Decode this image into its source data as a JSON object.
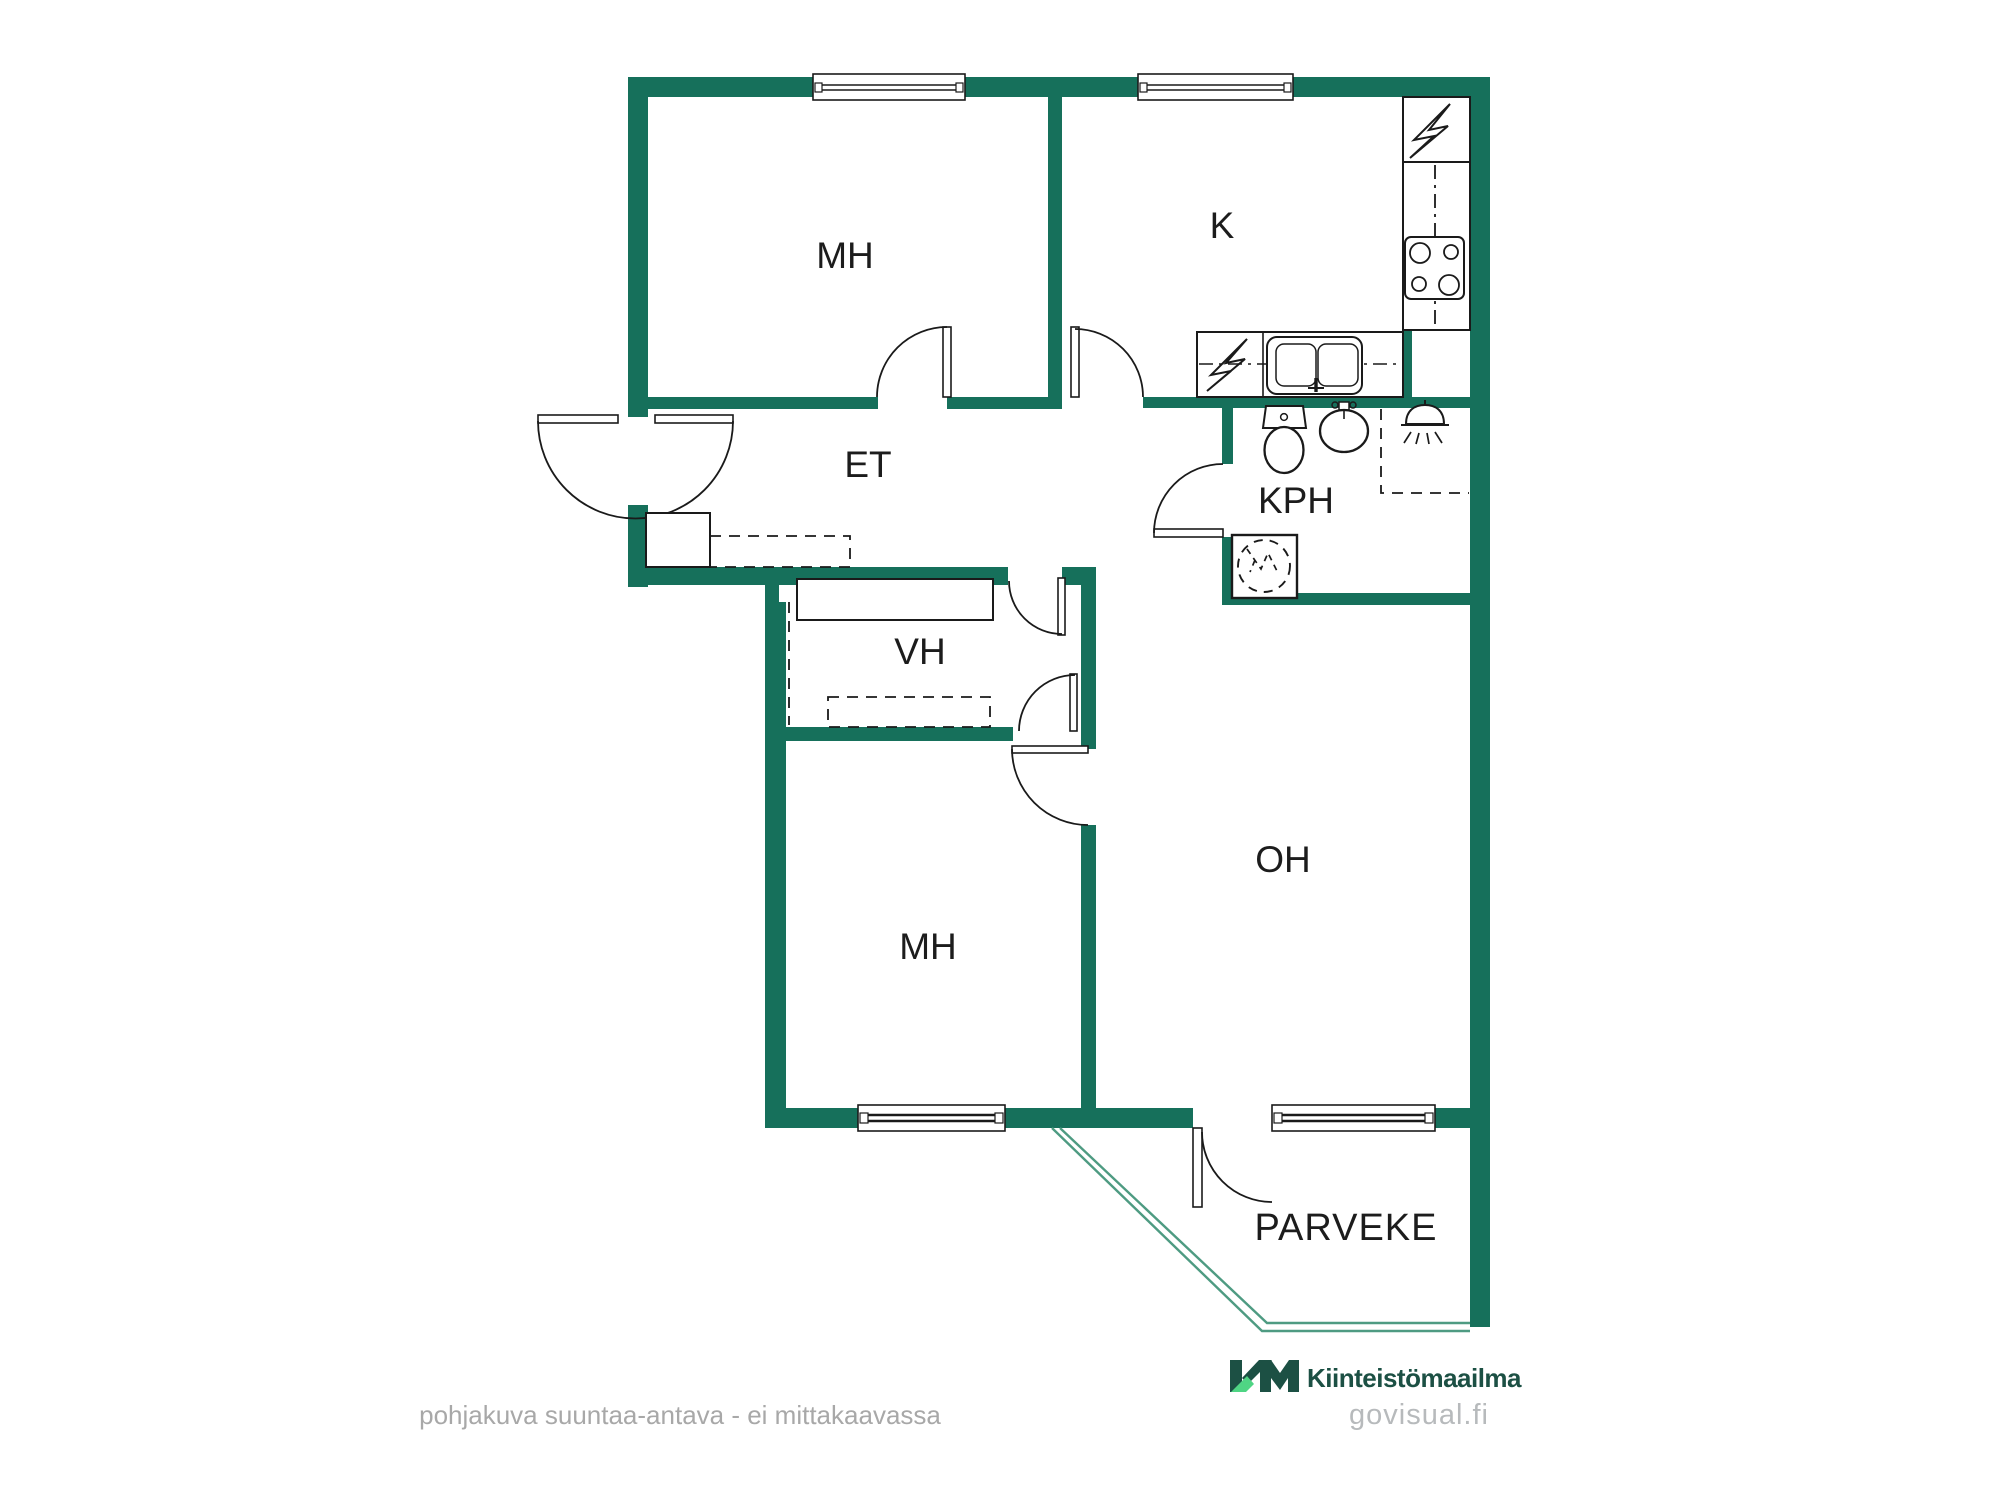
{
  "floorplan": {
    "title": "apartment floor plan",
    "rooms": [
      {
        "id": "mh1",
        "label": "MH"
      },
      {
        "id": "k",
        "label": "K"
      },
      {
        "id": "et",
        "label": "ET"
      },
      {
        "id": "kph",
        "label": "KPH"
      },
      {
        "id": "vh",
        "label": "VH"
      },
      {
        "id": "mh2",
        "label": "MH"
      },
      {
        "id": "oh",
        "label": "OH"
      },
      {
        "id": "parveke",
        "label": "PARVEKE"
      }
    ],
    "fixtures": [
      "refrigerator-icon",
      "stove-icon",
      "dishwasher-icon",
      "kitchen-sink-icon",
      "toilet-icon",
      "washbasin-icon",
      "shower-icon",
      "washing-machine-icon",
      "entrance-door",
      "wardrobe",
      "balcony-railing"
    ],
    "colors": {
      "wall": "#16705B",
      "railing": "#4E9B82",
      "line": "#1a1a1a"
    }
  },
  "branding": {
    "logo_text": "KM",
    "company": "Kiinteistömaailma",
    "website": "govisual.fi",
    "colors": {
      "dark": "#1C5044",
      "accent": "#4FD584"
    }
  },
  "footer": {
    "disclaimer": "pohjakuva suuntaa-antava - ei mittakaavassa"
  }
}
